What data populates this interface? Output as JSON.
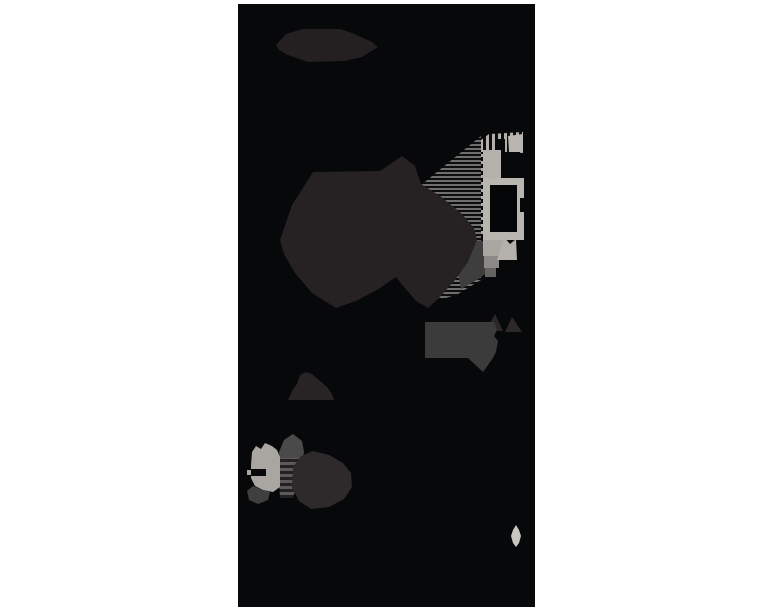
{
  "canvas": {
    "width": 768,
    "height": 614,
    "background": "#ffffff"
  },
  "photo": {
    "x": 238,
    "y": 4,
    "width": 297,
    "height": 603,
    "field_color": "#070809"
  },
  "palette": {
    "page_background": "#ffffff",
    "photo_field": "#070809",
    "dark_blob": "#262122",
    "hexagon_blob": "#242021",
    "gray_flag": "#3b3b3b",
    "flag_peaks": "#2c2829",
    "hill": "#282324",
    "mound": "#2e292a",
    "silver_bright": "#b4b1ac",
    "silver_mid": "#a9a6a1",
    "hatch_gray": "#6f6f6f",
    "band_gray": "#5a5a5a",
    "cap_gray": "#4a4a4a",
    "foot_gray": "#3f3f3f",
    "shadow_gray": "#3e3e3e",
    "leaf_bright": "#c9c6c1"
  },
  "scene": {
    "patterns": [
      {
        "id": "hatchH",
        "orient": "h",
        "a": "#6f6f6f",
        "b": "#0c0d0d",
        "a_px": 2,
        "b_px": 2
      },
      {
        "id": "hatchH2",
        "orient": "h",
        "a": "#5a5a5a",
        "b": "#222021",
        "a_px": 3,
        "b_px": 3
      },
      {
        "id": "hatchV",
        "orient": "v",
        "a": "#b3b0ab",
        "b": "#0c0d0d",
        "a_px": 3,
        "b_px": 3
      },
      {
        "id": "ticksH",
        "orient": "h",
        "a": "#aeaba6",
        "b": "none",
        "a_px": 3,
        "b_px": 4
      }
    ],
    "shapes": [
      {
        "name": "photo-field",
        "x": 238,
        "y": 4,
        "w": 297,
        "h": 603,
        "fill": "#070809"
      },
      {
        "name": "hexagon-blob",
        "points": "276,45 286,34 303,29 340,29 352,33 372,42 378,47 362,57 345,61 308,62 288,55 279,50",
        "fill": "#242021"
      },
      {
        "name": "hatch-wedge",
        "points": "415,190 481,136 481,280 458,294 440,300 425,250 415,210",
        "fill": "pattern:hatchH"
      },
      {
        "name": "under-frame-shadow",
        "points": "468,240 500,242 495,266 480,278 461,289 457,268",
        "fill": "#3e3e3e"
      },
      {
        "name": "central-silhouette",
        "points": "280,240 292,205 313,172 380,171 402,156 415,166 421,184 440,196 460,212 474,228 477,240 468,262 455,280 440,297 428,308 416,301 404,287 396,277 377,290 356,301 336,308 312,293 295,273 284,254",
        "fill": "#262122"
      },
      {
        "name": "rail-ticks",
        "x": 481,
        "y": 145,
        "w": 8,
        "h": 92,
        "fill": "pattern:ticksH"
      },
      {
        "name": "rail-cap",
        "points": "481,152 481,140 489,134 523,132 523,152",
        "fill": "pattern:hatchV"
      },
      {
        "name": "rail-cap-notch",
        "x": 495,
        "y": 139,
        "w": 10,
        "h": 14,
        "fill": "#070809"
      },
      {
        "name": "rail-upper-block",
        "x": 483,
        "y": 150,
        "w": 18,
        "h": 30,
        "fill": "#b4b1ac"
      },
      {
        "name": "rail-hook",
        "points": "508,136 523,134 523,153 509,152",
        "fill": "#b9b6b1"
      },
      {
        "name": "rail-c-notch",
        "x": 502,
        "y": 152,
        "w": 18,
        "h": 26,
        "fill": "#070809"
      },
      {
        "name": "rail-frame",
        "x": 483,
        "y": 178,
        "w": 41,
        "h": 62,
        "fill": "#b9b6b1"
      },
      {
        "name": "rail-window",
        "x": 490,
        "y": 185,
        "w": 27,
        "h": 47,
        "fill": "#050607"
      },
      {
        "name": "rail-frame-notch",
        "x": 520,
        "y": 198,
        "w": 4,
        "h": 14,
        "fill": "#070809"
      },
      {
        "name": "rail-step-1",
        "x": 483,
        "y": 240,
        "w": 20,
        "h": 16,
        "fill": "#a9a6a1"
      },
      {
        "name": "rail-step-2",
        "x": 484,
        "y": 256,
        "w": 15,
        "h": 12,
        "fill": "#8b8885"
      },
      {
        "name": "rail-step-3",
        "x": 485,
        "y": 268,
        "w": 11,
        "h": 9,
        "fill": "#636360"
      },
      {
        "name": "rail-arrow",
        "points": "497,260 504,237 510,244 516,239 517,260",
        "fill": "#b4b1ac"
      },
      {
        "name": "flag-peak-left",
        "points": "486,331 495,314 503,331",
        "fill": "#2c2829"
      },
      {
        "name": "flag-peak-right",
        "points": "505,332 512,317 522,332",
        "fill": "#2c2829"
      },
      {
        "name": "gray-flag",
        "points": "425,322 494,322 497,330 494,336 498,341 496,352 493,358 483,372 468,358 425,358",
        "fill": "#3b3b3b"
      },
      {
        "name": "small-hill",
        "points": "288,400 293,389 297,384 300,375 306,372 312,374 319,380 327,387 332,394 334,400",
        "fill": "#282324"
      },
      {
        "name": "band-cap",
        "points": "279,452 284,440 293,434 302,441 304,452 302,462 280,462",
        "fill": "#4a4a4a"
      },
      {
        "name": "band-stripes",
        "points": "278,458 303,458 298,480 293,498 280,498",
        "fill": "pattern:hatchH2"
      },
      {
        "name": "dark-mound",
        "points": "293,467 301,456 313,451 329,455 343,463 351,473 352,487 344,499 329,507 311,509 299,501 292,488",
        "fill": "#2e292a"
      },
      {
        "name": "bright-figure",
        "points": "252,452 256,446 261,449 265,443 272,446 277,450 280,457 280,487 273,492 263,490 255,486 251,478 251,465",
        "fill": "#a9a6a1"
      },
      {
        "name": "figure-slot",
        "x": 251,
        "y": 469,
        "w": 15,
        "h": 7,
        "fill": "#070809"
      },
      {
        "name": "figure-nub",
        "x": 247,
        "y": 470,
        "w": 4,
        "h": 5,
        "fill": "#a9a6a1"
      },
      {
        "name": "figure-foot",
        "points": "247,491 253,486 260,489 270,492 268,500 258,504 249,500",
        "fill": "#3f3f3f"
      },
      {
        "name": "light-leaf",
        "points": "516,525 519,530 521,536 519,543 516,547 513,543 511,536 513,530",
        "fill": "#c9c6c1"
      }
    ]
  }
}
